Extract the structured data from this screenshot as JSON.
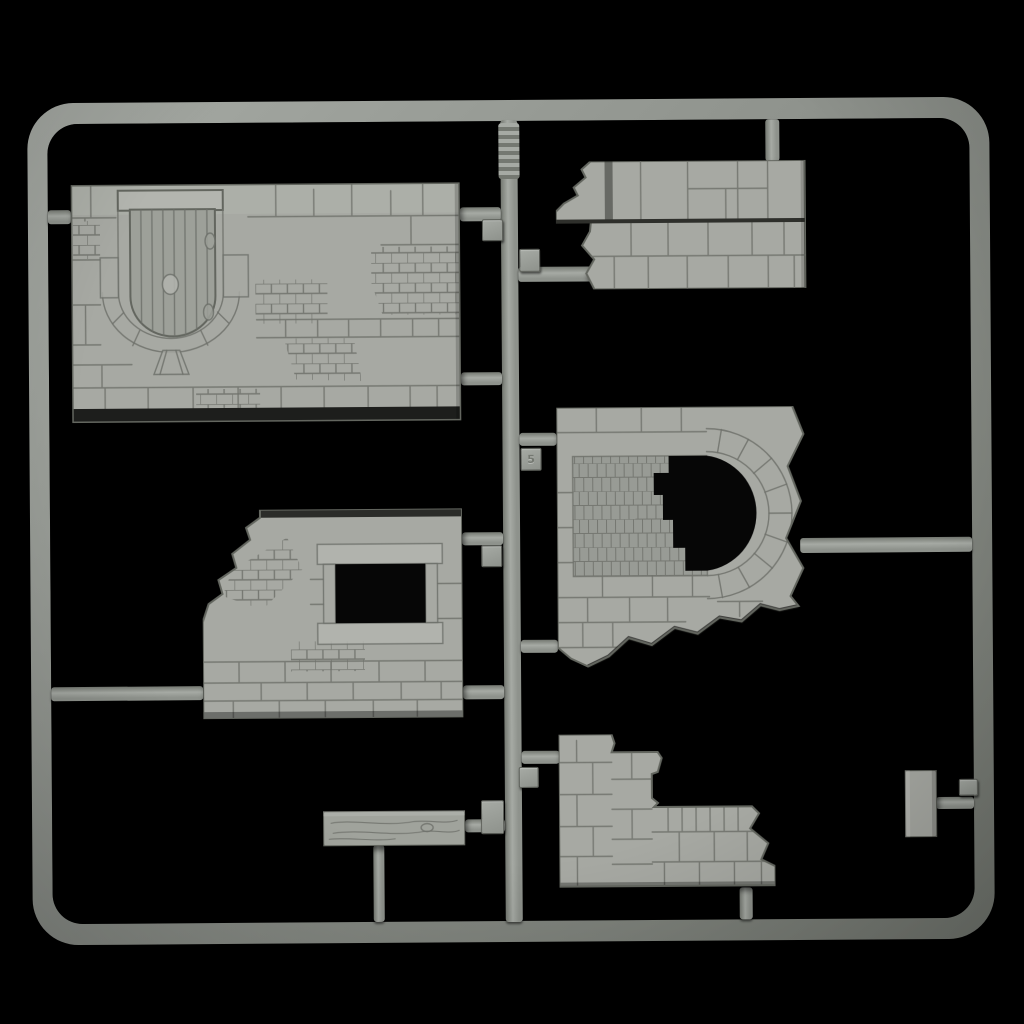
{
  "scene": {
    "description": "Product photo of a gray plastic model-kit sprue holding ruined stone-wall diorama parts on a black background",
    "object": "injection-molded sprue with wall parts"
  },
  "colors": {
    "background": "#000000",
    "frame": "#8e928c",
    "frame_light": "#a6aaa4",
    "frame_dark": "#747871",
    "part": "#a7a9a3",
    "part_light": "#b3b5af",
    "door": "#9da099",
    "panel": "#989b95",
    "mortar": "#6e716b",
    "dark": "#1d1e1c",
    "shadow": "#2e2f2b",
    "wood": "#a0a39c",
    "opening": "#060606"
  },
  "parts": [
    {
      "id": "wall-door",
      "label": "large wall section with arched wooden door (molded inverted)"
    },
    {
      "id": "wall-broken",
      "label": "broken wall section with large stone blocks"
    },
    {
      "id": "wall-arch",
      "label": "ruined wall with arched opening and brick infill panel"
    },
    {
      "id": "wall-window",
      "label": "ruined wall section with framed window opening"
    },
    {
      "id": "wall-stepped",
      "label": "stepped ruined wall section"
    },
    {
      "id": "wood-plank",
      "label": "wooden plank beam"
    },
    {
      "id": "small-panel",
      "label": "small rectangular panel part"
    }
  ],
  "tags": [
    {
      "label": ""
    },
    {
      "label": ""
    },
    {
      "label": "5"
    },
    {
      "label": ""
    },
    {
      "label": ""
    },
    {
      "label": ""
    },
    {
      "label": ""
    }
  ]
}
